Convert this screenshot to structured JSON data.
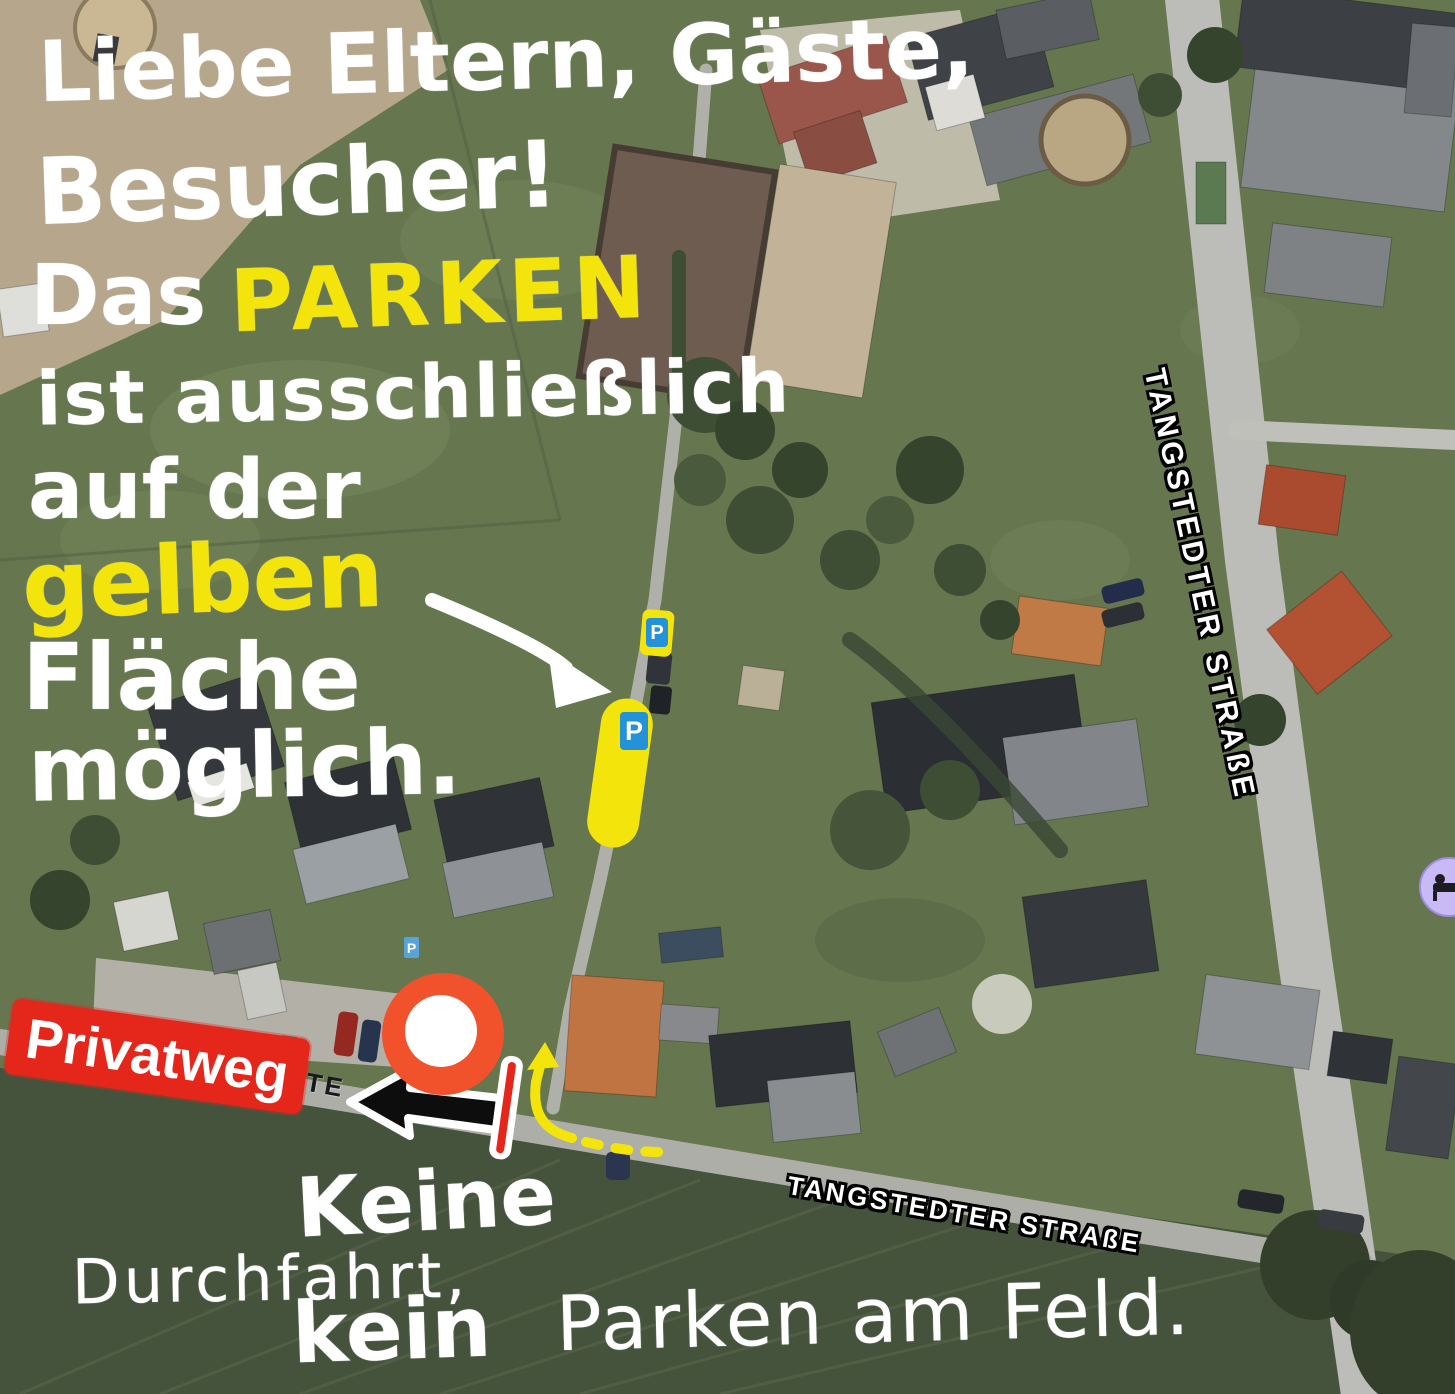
{
  "notice": {
    "line1": "Liebe Eltern, Gäste,",
    "line2": "Besucher!",
    "line3_prefix": "Das",
    "line3_highlight": "PARKEN",
    "line4": "ist ausschließlich",
    "line5": "auf der",
    "line6": "gelben",
    "line7": "Fläche",
    "line8": "möglich."
  },
  "bottom_notice": {
    "word1": "Keine",
    "word2": "Durchfahrt,",
    "word3": "kein",
    "word4": "Parken am Feld."
  },
  "labels": {
    "privatweg": "Privatweg",
    "street_vertical": "TANGSTEDTER STRAßE",
    "street_bottom": "TANGSTEDTER STRAßE",
    "street_partial": "TE"
  },
  "icons": {
    "parking_letter": "P"
  },
  "colors": {
    "highlight_yellow": "#f3e50c",
    "banner_red": "#e5261b",
    "marker_orange": "#f1512b",
    "parking_blue": "#2492d8",
    "hotel_purple": "#c9baf6",
    "handwriting_white": "#ffffff"
  }
}
